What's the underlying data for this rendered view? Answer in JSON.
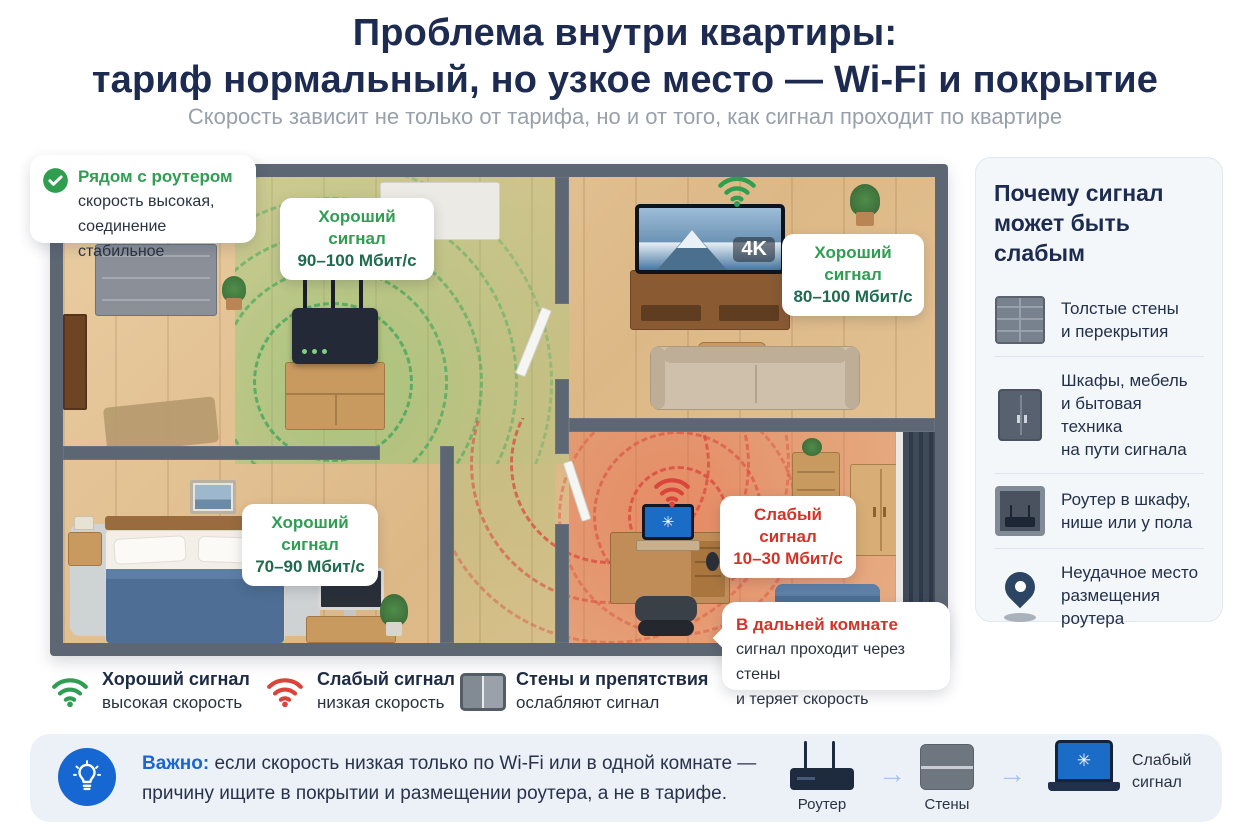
{
  "header": {
    "title_line1": "Проблема внутри квартиры:",
    "title_line2": "тариф нормальный, но узкое место — Wi-Fi и покрытие",
    "subtitle": "Скорость зависит не только от тарифа, но и от того, как сигнал проходит по квартире"
  },
  "floorplan": {
    "callout_good": {
      "title": "Рядом с роутером",
      "body": "скорость высокая,\nсоединение стабильное"
    },
    "label_hall": {
      "title": "Хороший сигнал",
      "value": "90–100 Мбит/с"
    },
    "label_tv": {
      "title": "Хороший сигнал",
      "value": "80–100 Мбит/с"
    },
    "label_bedroom": {
      "title": "Хороший сигнал",
      "value": "70–90 Мбит/с"
    },
    "label_far": {
      "title": "Слабый сигнал",
      "value": "10–30 Мбит/с"
    },
    "tv_badge": "4K",
    "callout_far": {
      "title": "В дальней комнате",
      "body": "сигнал проходит через стены\nи теряет скорость"
    }
  },
  "sidebar": {
    "title": "Почему сигнал\nможет быть слабым",
    "items": [
      {
        "icon": "brick-wall-icon",
        "text": "Толстые стены\nи перекрытия"
      },
      {
        "icon": "cabinet-icon",
        "text": "Шкафы, мебель\nи бытовая техника\nна пути сигнала"
      },
      {
        "icon": "router-in-niche-icon",
        "text": "Роутер в шкафу,\nнише или у пола"
      },
      {
        "icon": "location-pin-icon",
        "text": "Неудачное место\nразмещения роутера"
      }
    ]
  },
  "legend": {
    "items": [
      {
        "icon": "wifi-good-icon",
        "title": "Хороший сигнал",
        "subtitle": "высокая скорость"
      },
      {
        "icon": "wifi-bad-icon",
        "title": "Слабый сигнал",
        "subtitle": "низкая скорость"
      },
      {
        "icon": "wall-icon",
        "title": "Стены и препятствия",
        "subtitle": "ослабляют сигнал"
      }
    ]
  },
  "footer": {
    "important_label": "Важно:",
    "text_line1": "если скорость низкая только по Wi-Fi или в одной комнате —",
    "text_line2": "причину ищите в покрытии и размещении роутера, а не в тарифе.",
    "flow": [
      {
        "icon": "router-icon",
        "label": "Роутер"
      },
      {
        "icon": "wall-icon",
        "label": "Стены"
      },
      {
        "icon": "laptop-weak-icon",
        "label": "Слабый\nсигнал"
      }
    ]
  },
  "icons": {
    "arrow": "→",
    "spinner": "✳"
  },
  "colors": {
    "good_green": "#2f9e52",
    "good_dark": "#1f6b4e",
    "bad_red": "#d2342a",
    "title_navy": "#1d2b50",
    "accent_blue": "#1966d3",
    "wall_gray": "#5d6673"
  }
}
